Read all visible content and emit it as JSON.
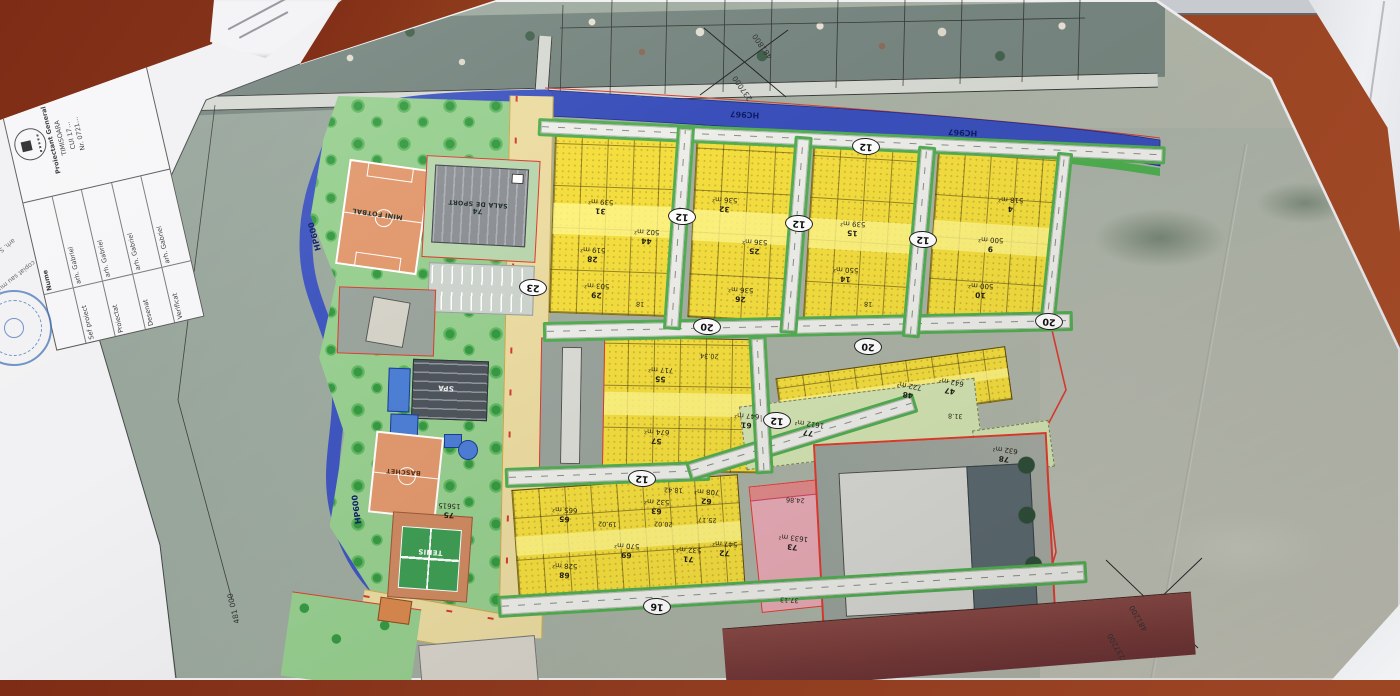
{
  "colors": {
    "table_brown": "#8e3b20",
    "parcel_yellow": "#f4de3f",
    "channel_blue": "#3a4fba",
    "park_green": "#98cf90",
    "boundary_red": "#e03c30",
    "pink_parcel": "#e8abb6",
    "sandy_road": "#ecdca2"
  },
  "plan": {
    "channel_label": "HC967",
    "ditch_label": "HP600",
    "streets": [
      "12",
      "12",
      "12",
      "12",
      "12",
      "12",
      "16",
      "20",
      "20",
      "20",
      "23"
    ],
    "facilities": {
      "field": "MINI FOTBAL",
      "hall_lot": "74",
      "hall": "SALA DE SPORT",
      "spa": "SPA",
      "basket": "BASCHET",
      "tennis": "TENIS",
      "park_lot": "75",
      "park_area": "15615"
    },
    "parcels": [
      {
        "lot": "31",
        "area": "539 m²"
      },
      {
        "lot": "28",
        "area": "519 m²"
      },
      {
        "lot": "44",
        "area": "502 m²"
      },
      {
        "lot": "29",
        "area": "503 m²"
      },
      {
        "lot": "32",
        "area": "536 m²"
      },
      {
        "lot": "25",
        "area": "536 m²"
      },
      {
        "lot": "26",
        "area": "536 m²"
      },
      {
        "lot": "15",
        "area": "539 m²"
      },
      {
        "lot": "14",
        "area": "550 m²"
      },
      {
        "lot": "9",
        "area": "500 m²"
      },
      {
        "lot": "10",
        "area": "500 m²"
      },
      {
        "lot": "4",
        "area": "518 m²"
      },
      {
        "lot": "55",
        "area": "717 m²"
      },
      {
        "lot": "57",
        "area": "674 m²"
      },
      {
        "lot": "61",
        "area": "647 m²"
      },
      {
        "lot": "48",
        "area": "722 m²"
      },
      {
        "lot": "47",
        "area": "642 m²"
      },
      {
        "lot": "65",
        "area": "665 m²"
      },
      {
        "lot": "63",
        "area": "532 m²"
      },
      {
        "lot": "62",
        "area": "708 m²"
      },
      {
        "lot": "69",
        "area": "570 m²"
      },
      {
        "lot": "71",
        "area": "532 m²"
      },
      {
        "lot": "72",
        "area": "547 m²"
      },
      {
        "lot": "68",
        "area": "528 m²"
      }
    ],
    "special": {
      "p73_lot": "73",
      "p73_area": "1633 m²",
      "p73_dim1": "24.86",
      "p73_dim2": "37.13",
      "p77_lot": "77",
      "p77_area": "1612 m²",
      "p78_lot": "78",
      "p78_area": "632 m²"
    },
    "dims": [
      "18",
      "18",
      "20.02",
      "25.17",
      "18.42",
      "31.8",
      "20.34",
      "19.02"
    ],
    "coords": {
      "top_e": "237000",
      "top_n": "481800",
      "bot_e": "237200",
      "bot_n": "481200",
      "left_n": "481 000"
    }
  },
  "titleblock": {
    "header_name": "Nume",
    "rows": [
      {
        "role": "Sef proiect",
        "name": "arh. Gabriel"
      },
      {
        "role": "Proiectat",
        "name": "arh. Gabriel"
      },
      {
        "role": "Desenat",
        "name": "arh. Gabriel"
      },
      {
        "role": "Verificat",
        "name": "arh. Gabriel"
      }
    ],
    "firm_title": "Proiectant General",
    "firm_city": "TIMISOARA",
    "firm_line1": "CUI 17…",
    "firm_line2": "Nr. 0721…",
    "note1": "arh. SANTO G. GABRIEL",
    "note2": "copiat sau multiplicat"
  }
}
